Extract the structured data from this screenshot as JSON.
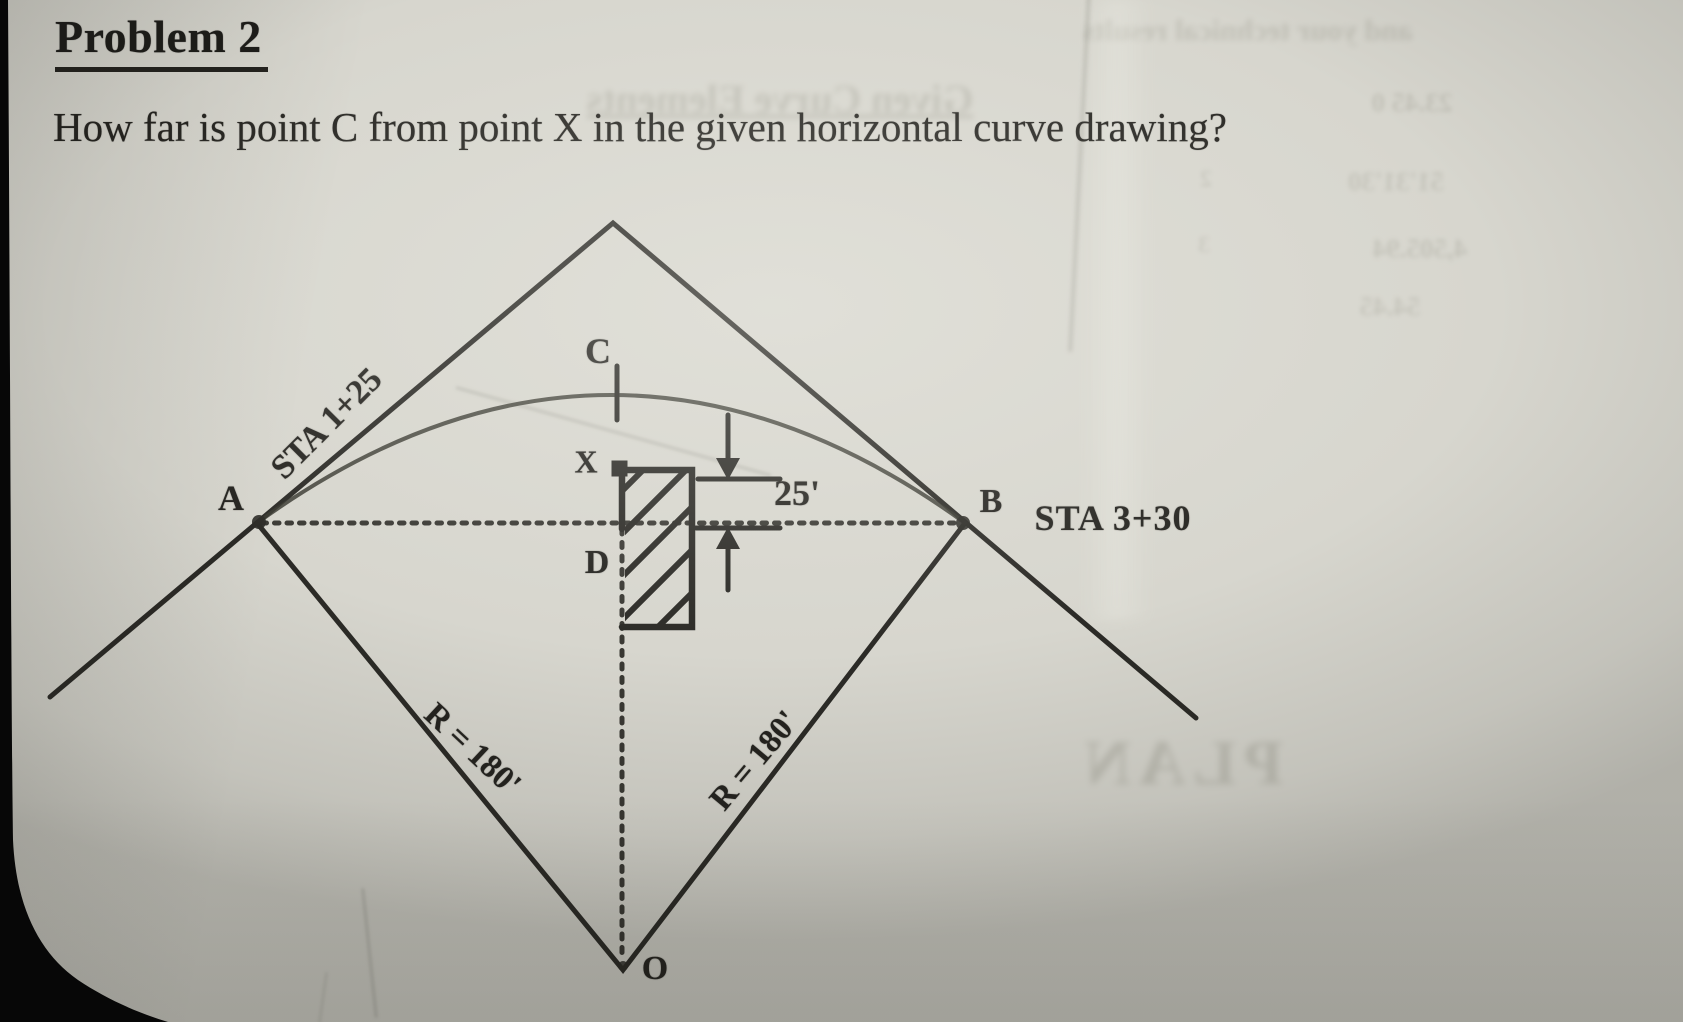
{
  "document": {
    "title": "Problem 2",
    "question": "How far is point C from point X in the given horizontal curve drawing?"
  },
  "diagram": {
    "points": {
      "a": "A",
      "b": "B",
      "c": "C",
      "d": "D",
      "x": "X",
      "o": "O"
    },
    "stations": {
      "a": "STA 1+25",
      "b": "STA 3+30"
    },
    "radius_left": "R = 180'",
    "radius_right": "R = 180'",
    "offset": "25'"
  },
  "bleed_through": {
    "heading": "Given Curve Elements",
    "top_right": "and your technical results",
    "row_values": [
      "23.45 0",
      "51'31'30",
      "4,505.94",
      "54.45"
    ],
    "row_numbers": [
      "2",
      "3"
    ],
    "plan": "PLAN"
  },
  "colors": {
    "paper": "#d7d6ce",
    "ink": "#2b2a26",
    "photo_edge": "#070707"
  }
}
